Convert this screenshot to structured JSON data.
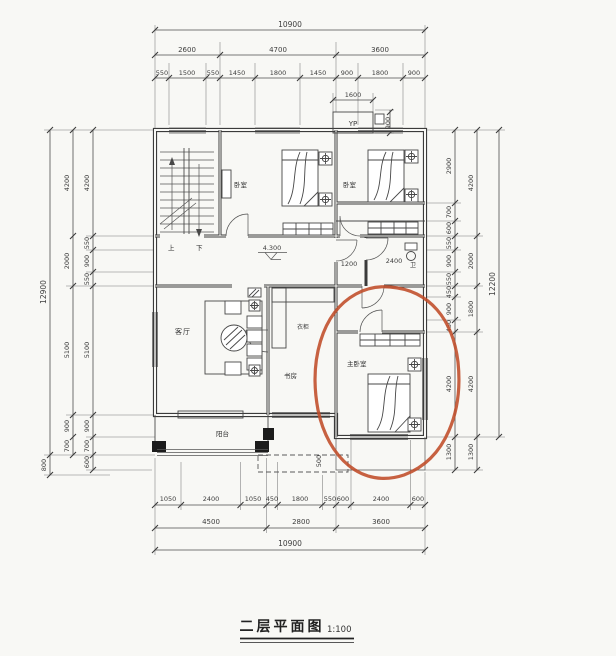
{
  "title": {
    "name": "二层平面图",
    "scale": "1:100"
  },
  "rooms": {
    "stair_up": "上",
    "stair_down": "下",
    "bedroom_mid": "卧室",
    "bedroom_right": "卧室",
    "living": "客厅",
    "wardrobe": "衣柜",
    "study": "书房",
    "master": "主卧室",
    "balcony": "阳台",
    "canopy": "YP",
    "toilet": "卫"
  },
  "dims": {
    "top": {
      "total": "10900",
      "segments": [
        "2600",
        "4700",
        "3600"
      ],
      "detail": [
        "550",
        "1500",
        "550",
        "1450",
        "1800",
        "1450",
        "900",
        "1800",
        "900"
      ]
    },
    "canopy": {
      "width": "1600",
      "depth": "900"
    },
    "left": {
      "total": "12900",
      "segments": [
        "4200",
        "2000",
        "5100",
        "900",
        "700"
      ],
      "detail": [
        "4200",
        "550",
        "900",
        "550",
        "5100",
        "900",
        "700",
        "600"
      ],
      "below": "800"
    },
    "right": {
      "total": "12200",
      "segments": [
        "4200",
        "2000",
        "1800",
        "4200",
        "1300"
      ],
      "detail": [
        "2900",
        "700",
        "600",
        "550",
        "900",
        "550",
        "450",
        "900",
        "450",
        "4200",
        "1300"
      ]
    },
    "bottom": {
      "total": "10900",
      "segments": [
        "4500",
        "2800",
        "3600"
      ],
      "detail": [
        "1050",
        "2400",
        "1050",
        "450",
        "1800",
        "550",
        "600",
        "2400",
        "600"
      ]
    },
    "interior": {
      "hall": "1200",
      "bath": "2400",
      "level": "4.300",
      "overhang": "500"
    }
  },
  "colors": {
    "line": "#3b3b3b",
    "marker": "#bf4b28",
    "paper": "#f8f8f5"
  }
}
